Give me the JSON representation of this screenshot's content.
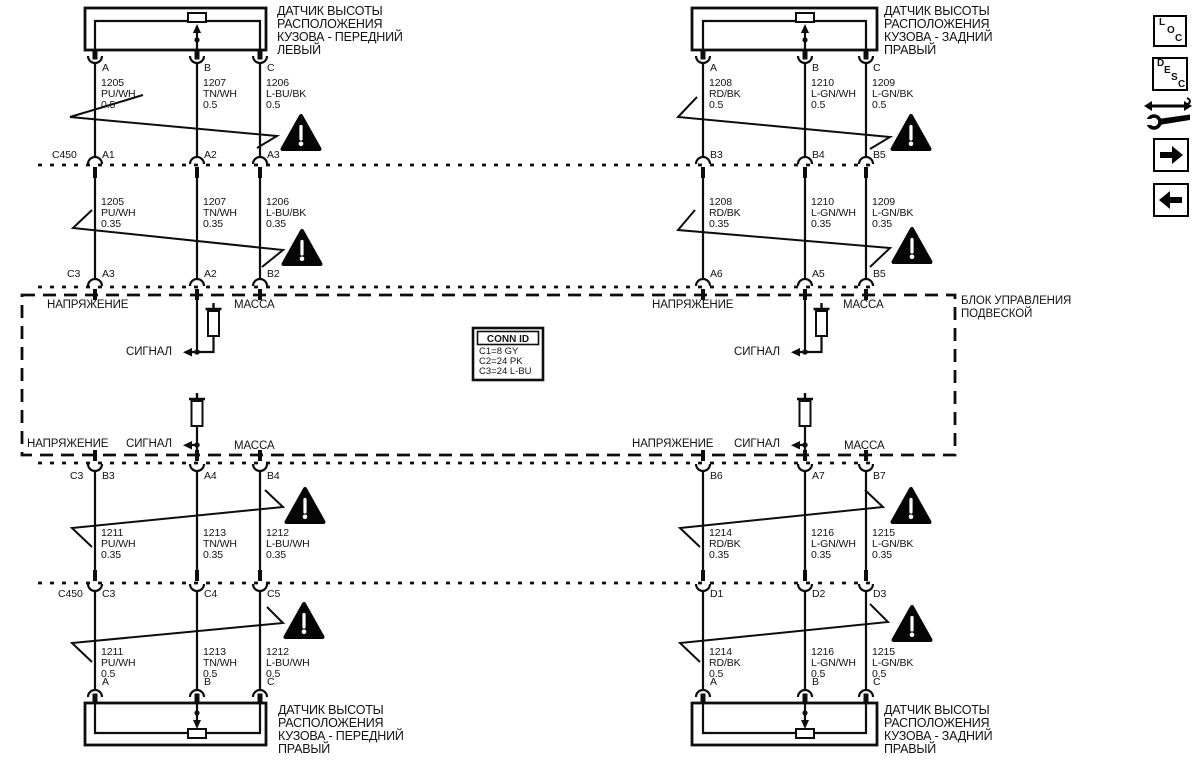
{
  "page": {
    "paper": "#ffffff",
    "ink": "#121212"
  },
  "sensors": {
    "front_left": {
      "l1": "ДАТЧИК ВЫСОТЫ",
      "l2": "РАСПОЛОЖЕНИЯ",
      "l3": "КУЗОВА - ПЕРЕДНИЙ",
      "l4": "ЛЕВЫЙ"
    },
    "rear_right_top": {
      "l1": "ДАТЧИК ВЫСОТЫ",
      "l2": "РАСПОЛОЖЕНИЯ",
      "l3": "КУЗОВА - ЗАДНИЙ",
      "l4": "ПРАВЫЙ"
    },
    "front_right": {
      "l1": "ДАТЧИК ВЫСОТЫ",
      "l2": "РАСПОЛОЖЕНИЯ",
      "l3": "КУЗОВА - ПЕРЕДНИЙ",
      "l4": "ПРАВЫЙ"
    },
    "rear_right_bottom": {
      "l1": "ДАТЧИК ВЫСОТЫ",
      "l2": "РАСПОЛОЖЕНИЯ",
      "l3": "КУЗОВА - ЗАДНИЙ",
      "l4": "ПРАВЫЙ"
    }
  },
  "pins": {
    "a": "A",
    "b": "B",
    "c": "C"
  },
  "gauges": {
    "thick": "0.5",
    "thin": "0.35"
  },
  "wires": {
    "tl": [
      {
        "id": "1205",
        "color": "PU/WH"
      },
      {
        "id": "1207",
        "color": "TN/WH"
      },
      {
        "id": "1206",
        "color": "L-BU/BK"
      }
    ],
    "tr": [
      {
        "id": "1208",
        "color": "RD/BK"
      },
      {
        "id": "1210",
        "color": "L-GN/WH"
      },
      {
        "id": "1209",
        "color": "L-GN/BK"
      }
    ],
    "bl": [
      {
        "id": "1211",
        "color": "PU/WH"
      },
      {
        "id": "1213",
        "color": "TN/WH"
      },
      {
        "id": "1212",
        "color": "L-BU/WH"
      }
    ],
    "br": [
      {
        "id": "1214",
        "color": "RD/BK"
      },
      {
        "id": "1216",
        "color": "L-GN/WH"
      },
      {
        "id": "1215",
        "color": "L-GN/BK"
      }
    ]
  },
  "connectors": {
    "row1": {
      "label": "C450",
      "l": [
        "A1",
        "A2",
        "A3"
      ],
      "r": [
        "B3",
        "B4",
        "B5"
      ]
    },
    "row2": {
      "label": "C3",
      "l": [
        "A3",
        "A2",
        "B2"
      ],
      "r": [
        "A6",
        "A5",
        "B5"
      ]
    },
    "row3": {
      "label": "C3",
      "l": [
        "B3",
        "A4",
        "B4"
      ],
      "r": [
        "B6",
        "A7",
        "B7"
      ]
    },
    "row4": {
      "label": "C450",
      "l": [
        "C3",
        "C4",
        "C5"
      ],
      "r": [
        "D1",
        "D2",
        "D3"
      ]
    }
  },
  "module": {
    "name_l1": "БЛОК УПРАВЛЕНИЯ",
    "name_l2": "ПОДВЕСКОЙ",
    "voltage": "НАПРЯЖЕНИЕ",
    "ground": "МАССА",
    "signal": "СИГНАЛ"
  },
  "conn_id": {
    "title": "CONN ID",
    "r1": "C1=8 GY",
    "r2": "C2=24 PK",
    "r3": "C3=24 L-BU"
  },
  "toolbar": {
    "loc": {
      "l1": "L",
      "l2": "O",
      "l3": "C"
    },
    "desc": {
      "l1": "D",
      "l2": "E",
      "l3": "S",
      "l4": "C"
    }
  }
}
